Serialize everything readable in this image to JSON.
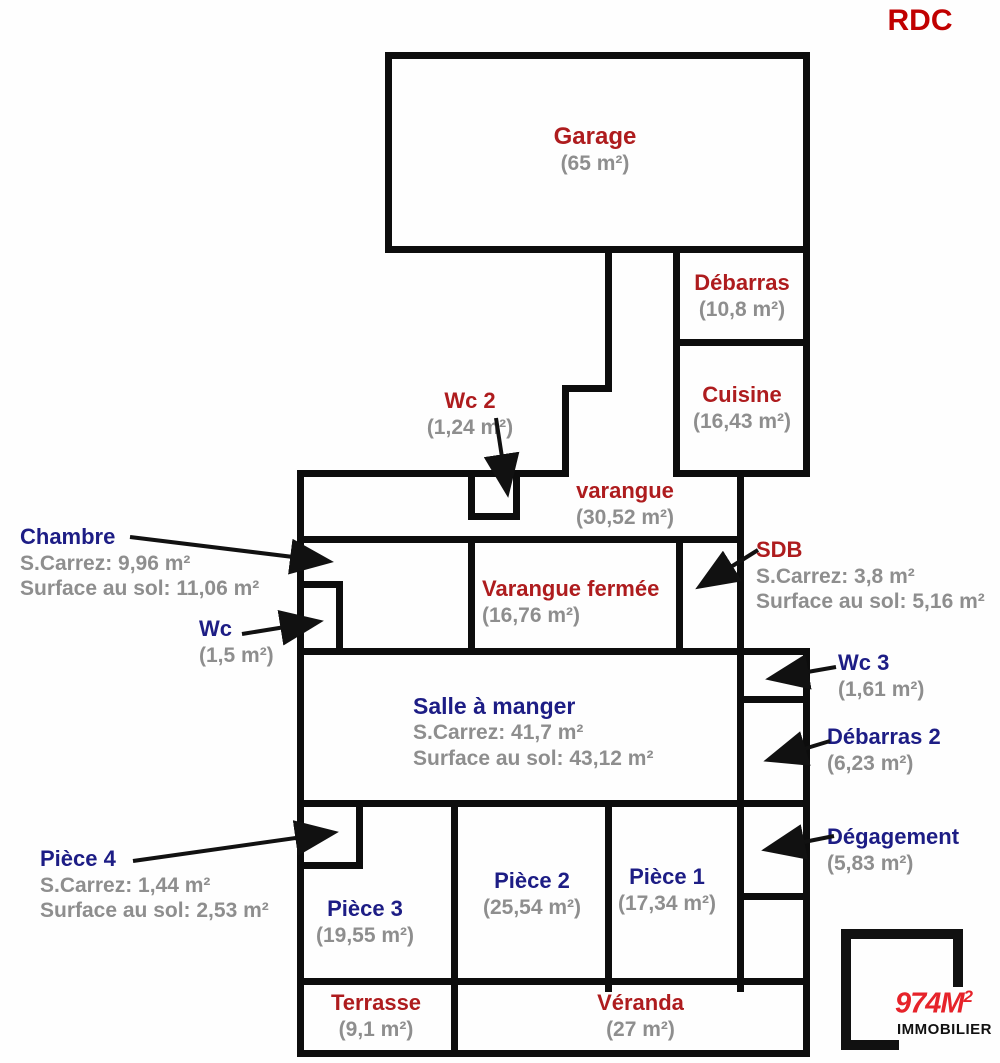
{
  "title": "RDC",
  "colors": {
    "room_label_red": "#ae1c1e",
    "annotation_navy": "#1d1d85",
    "area_gray": "#8e8e8e",
    "wall_black": "#0d0d0d",
    "logo_red": "#e6232a"
  },
  "rooms": {
    "garage": {
      "name": "Garage",
      "area": "(65 m²)"
    },
    "debarras": {
      "name": "Débarras",
      "area": "(10,8 m²)"
    },
    "cuisine": {
      "name": "Cuisine",
      "area": "(16,43 m²)"
    },
    "wc2": {
      "name": "Wc 2",
      "area": "(1,24 m²)"
    },
    "varangue": {
      "name": "varangue",
      "area": "(30,52 m²)"
    },
    "chambre": {
      "name": "Chambre",
      "carrez": "S.Carrez: 9,96 m²",
      "sol": "Surface au sol: 11,06 m²"
    },
    "sdb": {
      "name": "SDB",
      "carrez": "S.Carrez: 3,8 m²",
      "sol": "Surface au sol: 5,16 m²"
    },
    "varangue_fermee": {
      "name": "Varangue fermée",
      "area": "(16,76 m²)"
    },
    "wc": {
      "name": "Wc",
      "area": "(1,5 m²)"
    },
    "salle_a_manger": {
      "name": "Salle à manger",
      "carrez": "S.Carrez: 41,7 m²",
      "sol": "Surface au sol: 43,12 m²"
    },
    "wc3": {
      "name": "Wc 3",
      "area": "(1,61 m²)"
    },
    "debarras2": {
      "name": "Débarras 2",
      "area": "(6,23 m²)"
    },
    "degagement": {
      "name": "Dégagement",
      "area": "(5,83 m²)"
    },
    "piece4": {
      "name": "Pièce 4",
      "carrez": "S.Carrez: 1,44 m²",
      "sol": "Surface au sol: 2,53 m²"
    },
    "piece3": {
      "name": "Pièce 3",
      "area": "(19,55 m²)"
    },
    "piece2": {
      "name": "Pièce 2",
      "area": "(25,54 m²)"
    },
    "piece1": {
      "name": "Pièce 1",
      "area": "(17,34 m²)"
    },
    "terrasse": {
      "name": "Terrasse",
      "area": "(9,1 m²)"
    },
    "veranda": {
      "name": "Véranda",
      "area": "(27 m²)"
    }
  },
  "logo": {
    "brand": "974M",
    "brand_sup": "2",
    "subtitle": "IMMOBILIER"
  }
}
